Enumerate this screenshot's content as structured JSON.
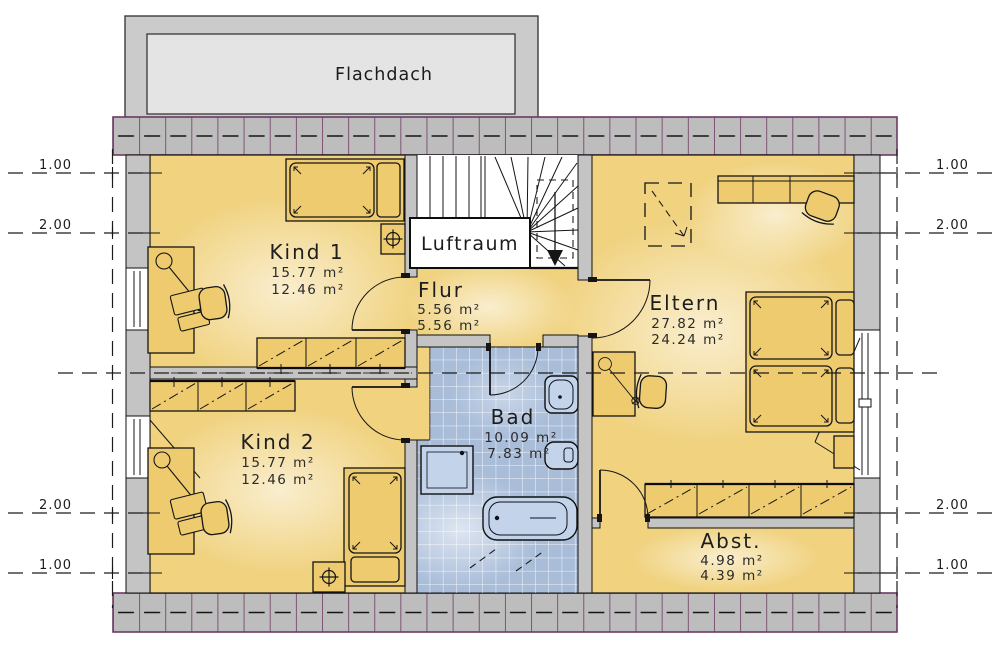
{
  "plan": {
    "roof_label": "Flachdach",
    "void_label": "Luftraum",
    "rooms": {
      "kind1": {
        "name": "Kind 1",
        "area_gross": "15.77 m²",
        "area_net": "12.46 m²"
      },
      "kind2": {
        "name": "Kind 2",
        "area_gross": "15.77 m²",
        "area_net": "12.46 m²"
      },
      "flur": {
        "name": "Flur",
        "area_gross": "5.56 m²",
        "area_net": "5.56 m²"
      },
      "eltern": {
        "name": "Eltern",
        "area_gross": "27.82 m²",
        "area_net": "24.24 m²"
      },
      "bad": {
        "name": "Bad",
        "area_gross": "10.09 m²",
        "area_net": "7.83 m²"
      },
      "abst": {
        "name": "Abst.",
        "area_gross": "4.98 m²",
        "area_net": "4.39 m²"
      }
    },
    "dimension_marks": {
      "left": [
        "1.00",
        "2.00",
        "2.00",
        "1.00"
      ],
      "right": [
        "1.00",
        "2.00",
        "2.00",
        "1.00"
      ]
    },
    "colors": {
      "room_fill": "#f0d27f",
      "room_glow": "#fdf2c4",
      "furniture_fill": "#eecb6e",
      "wall_fill": "#c4c4c4",
      "hatch_fill": "#bdbdbd",
      "hatch_line": "#6e3a64",
      "tile_fill": "#a9bdd9",
      "roof_outer": "#cbcbcb",
      "roof_inner": "#e4e4e4"
    }
  }
}
